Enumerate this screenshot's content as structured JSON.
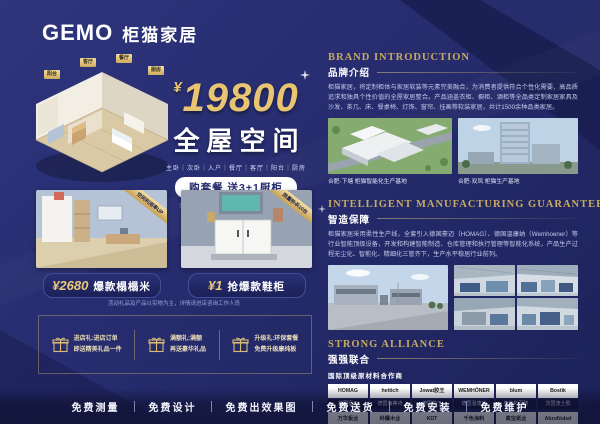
{
  "brand": {
    "logo_en": "GEMO",
    "logo_cn": "柜猫家居"
  },
  "hero": {
    "currency": "¥",
    "price": "19800",
    "title": "全屋空间",
    "rooms": "主卧｜次卧｜入户｜餐厅｜客厅｜阳台｜厨房",
    "cta": "购套餐 送3+1厨柜",
    "fine_print": "活动期间再送2㎡柜体投影面积（仅限前10名）",
    "room_labels": [
      "阳台",
      "客厅",
      "餐厅",
      "厨房"
    ]
  },
  "cards": [
    {
      "price": "¥2680",
      "label": "爆款榻榻米",
      "ribbon": "空间利用率UP"
    },
    {
      "price": "¥1",
      "label": "抢爆款鞋柜",
      "ribbon": "限量秒杀10台"
    }
  ],
  "cards_note": "活动礼品及产品以实物为主，详情请进店咨询工作人员",
  "gifts": [
    {
      "line1": "进店礼:进店订单",
      "line2": "即送精美礼品一件"
    },
    {
      "line1": "满额礼:满额",
      "line2": "再送豪华礼品"
    },
    {
      "line1": "升级礼:环保套餐",
      "line2": "免费升级康纯板"
    }
  ],
  "sections": {
    "brand_intro": {
      "title_en": "BRAND INTRODUCTION",
      "title_cn": "品牌介绍",
      "body": "柜猫家居，将定制柜体与家居软装等元素完美融合，为消费者提供符合个性化需要、高品质追求和独具个性价值的全屋家居整合。产品涵盖衣柜、橱柜、酒柜等全品类定制家居家具及沙发、茶几、床、餐桌椅、灯饰、窗帘、挂画等软装家居，共计1500余种品类家居。",
      "captions": [
        "合肥·下塘 柜猫智能化生产基地",
        "合肥·双凤 柜猫生产基地"
      ]
    },
    "manufacturing": {
      "title_en": "INTELLIGENT MANUFACTURING GUARANTEE",
      "title_cn": "智造保障",
      "body": "柜猫家居采用柔性生产线，全套引入德国豪迈（HOMAG）、德国温康纳（Wemhoener）等行业智能顶级设备，开发和构建智能制造、仓库管理和执行管理等智能化系统，产品生产过程无尘化、智能化、精细化三管齐下，生产水平稳居行业前列。"
    },
    "alliance": {
      "title_en": "STRONG ALLIANCE",
      "title_cn": "强强联合",
      "subtitle": "国际顶级原材料合作商",
      "partners": [
        {
          "logo": "HOMAG",
          "name": "德国豪迈"
        },
        {
          "logo": "hettich",
          "name": "德国海蒂诗"
        },
        {
          "logo": "Jowat胶王",
          "name": "德国胶王"
        },
        {
          "logo": "WEMHÖNER",
          "name": "德国温康纳"
        },
        {
          "logo": "blum",
          "name": "奥地利百隆"
        },
        {
          "logo": "Bostik",
          "name": "法国波士胶"
        },
        {
          "logo": "万华板业",
          "name": "万华板业"
        },
        {
          "logo": "科檀木业",
          "name": "科檀木业"
        },
        {
          "logo": "KDT",
          "name": "极东机械"
        },
        {
          "logo": "千色涂料",
          "name": "华润涂料"
        },
        {
          "logo": "高宝纸业",
          "name": "鑫宝纸业"
        },
        {
          "logo": "AkzoNobel",
          "name": "阿克苏诺贝尔"
        }
      ]
    }
  },
  "footer": {
    "services": [
      "免费测量",
      "免费设计",
      "免费出效果图",
      "免费送货",
      "免费安装",
      "免费维护"
    ]
  },
  "colors": {
    "background": "#272d70",
    "gold": "#e9c573",
    "navy_pill": "#1b2057"
  }
}
